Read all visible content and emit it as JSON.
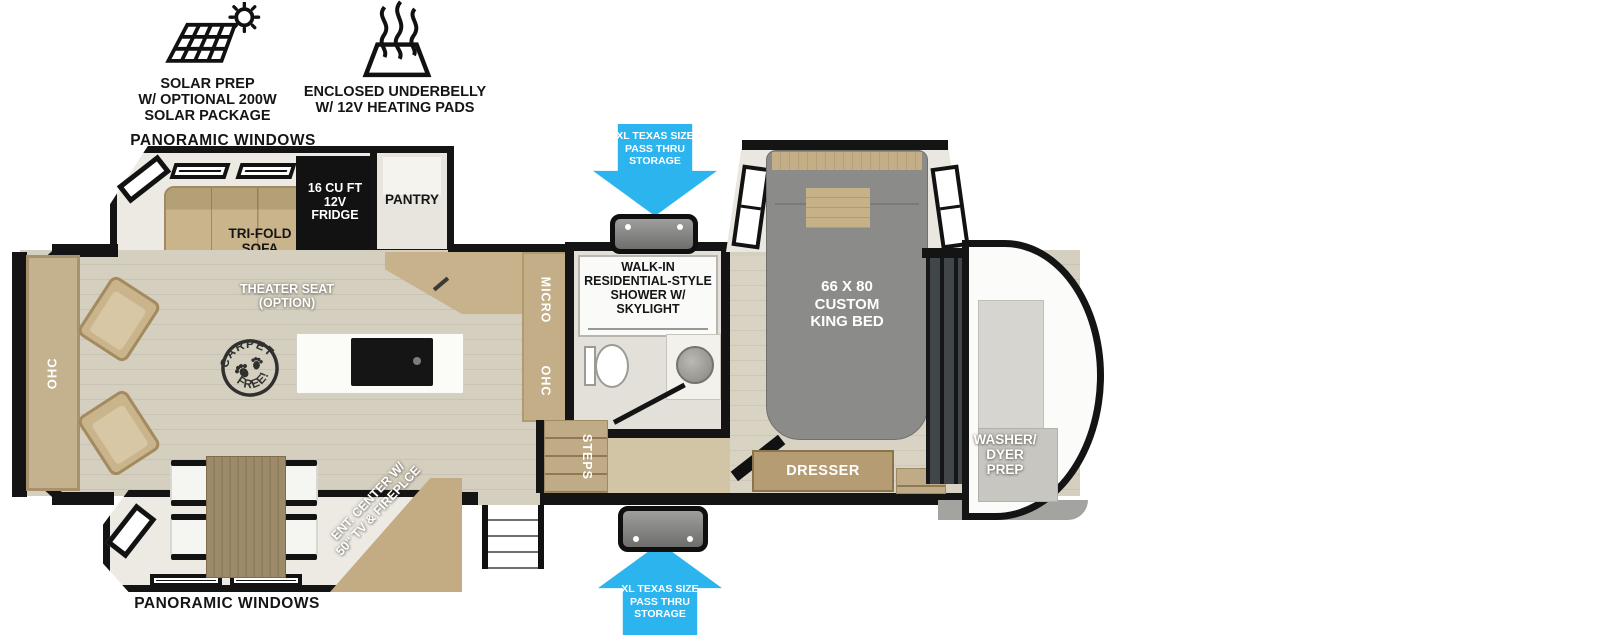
{
  "header": {
    "solar_label": "SOLAR PREP\nW/ OPTIONAL 200W\nSOLAR PACKAGE",
    "underbelly_label": "ENCLOSED UNDERBELLY\nW/ 12V HEATING PADS"
  },
  "exterior": {
    "pass_thru_top_label": "XL TEXAS SIZE\nPASS THRU\nSTORAGE",
    "pass_thru_bottom_label": "XL TEXAS SIZE\nPASS THRU\nSTORAGE",
    "panoramic_windows_top": "PANORAMIC WINDOWS",
    "panoramic_windows_left": "PANORAMIC WINDOWS",
    "panoramic_windows_bottom": "PANORAMIC WINDOWS"
  },
  "living_area": {
    "tri_fold_sofa": "TRI-FOLD\nSOFA",
    "theater_seat": "THEATER SEAT\n(OPTION)",
    "ohc": "OHC",
    "carpet_stamp": {
      "top": "CARPET",
      "bottom": "FREE!"
    },
    "ent_center": "ENT. CENTER W/\n50\" TV & FIREPLCE"
  },
  "kitchen": {
    "fridge": "16 CU FT\n12V\nFRIDGE",
    "pantry": "PANTRY",
    "micro": "MICRO",
    "ohc": "OHC"
  },
  "bathroom": {
    "shower": "WALK-IN\nRESIDENTIAL-STYLE\nSHOWER W/\nSKYLIGHT",
    "steps": "STEPS"
  },
  "bedroom": {
    "king_bed": "66 X 80\nCUSTOM\nKING BED",
    "dresser": "DRESSER",
    "washer_dryer": "WASHER/\nDYER\nPREP"
  },
  "colors": {
    "wall": "#141414",
    "floor": "#d5cfc0",
    "cabinet_tan": "#c5b08a",
    "bed_grey": "#8b8b8a",
    "accent_blue": "#2bb4ee"
  }
}
